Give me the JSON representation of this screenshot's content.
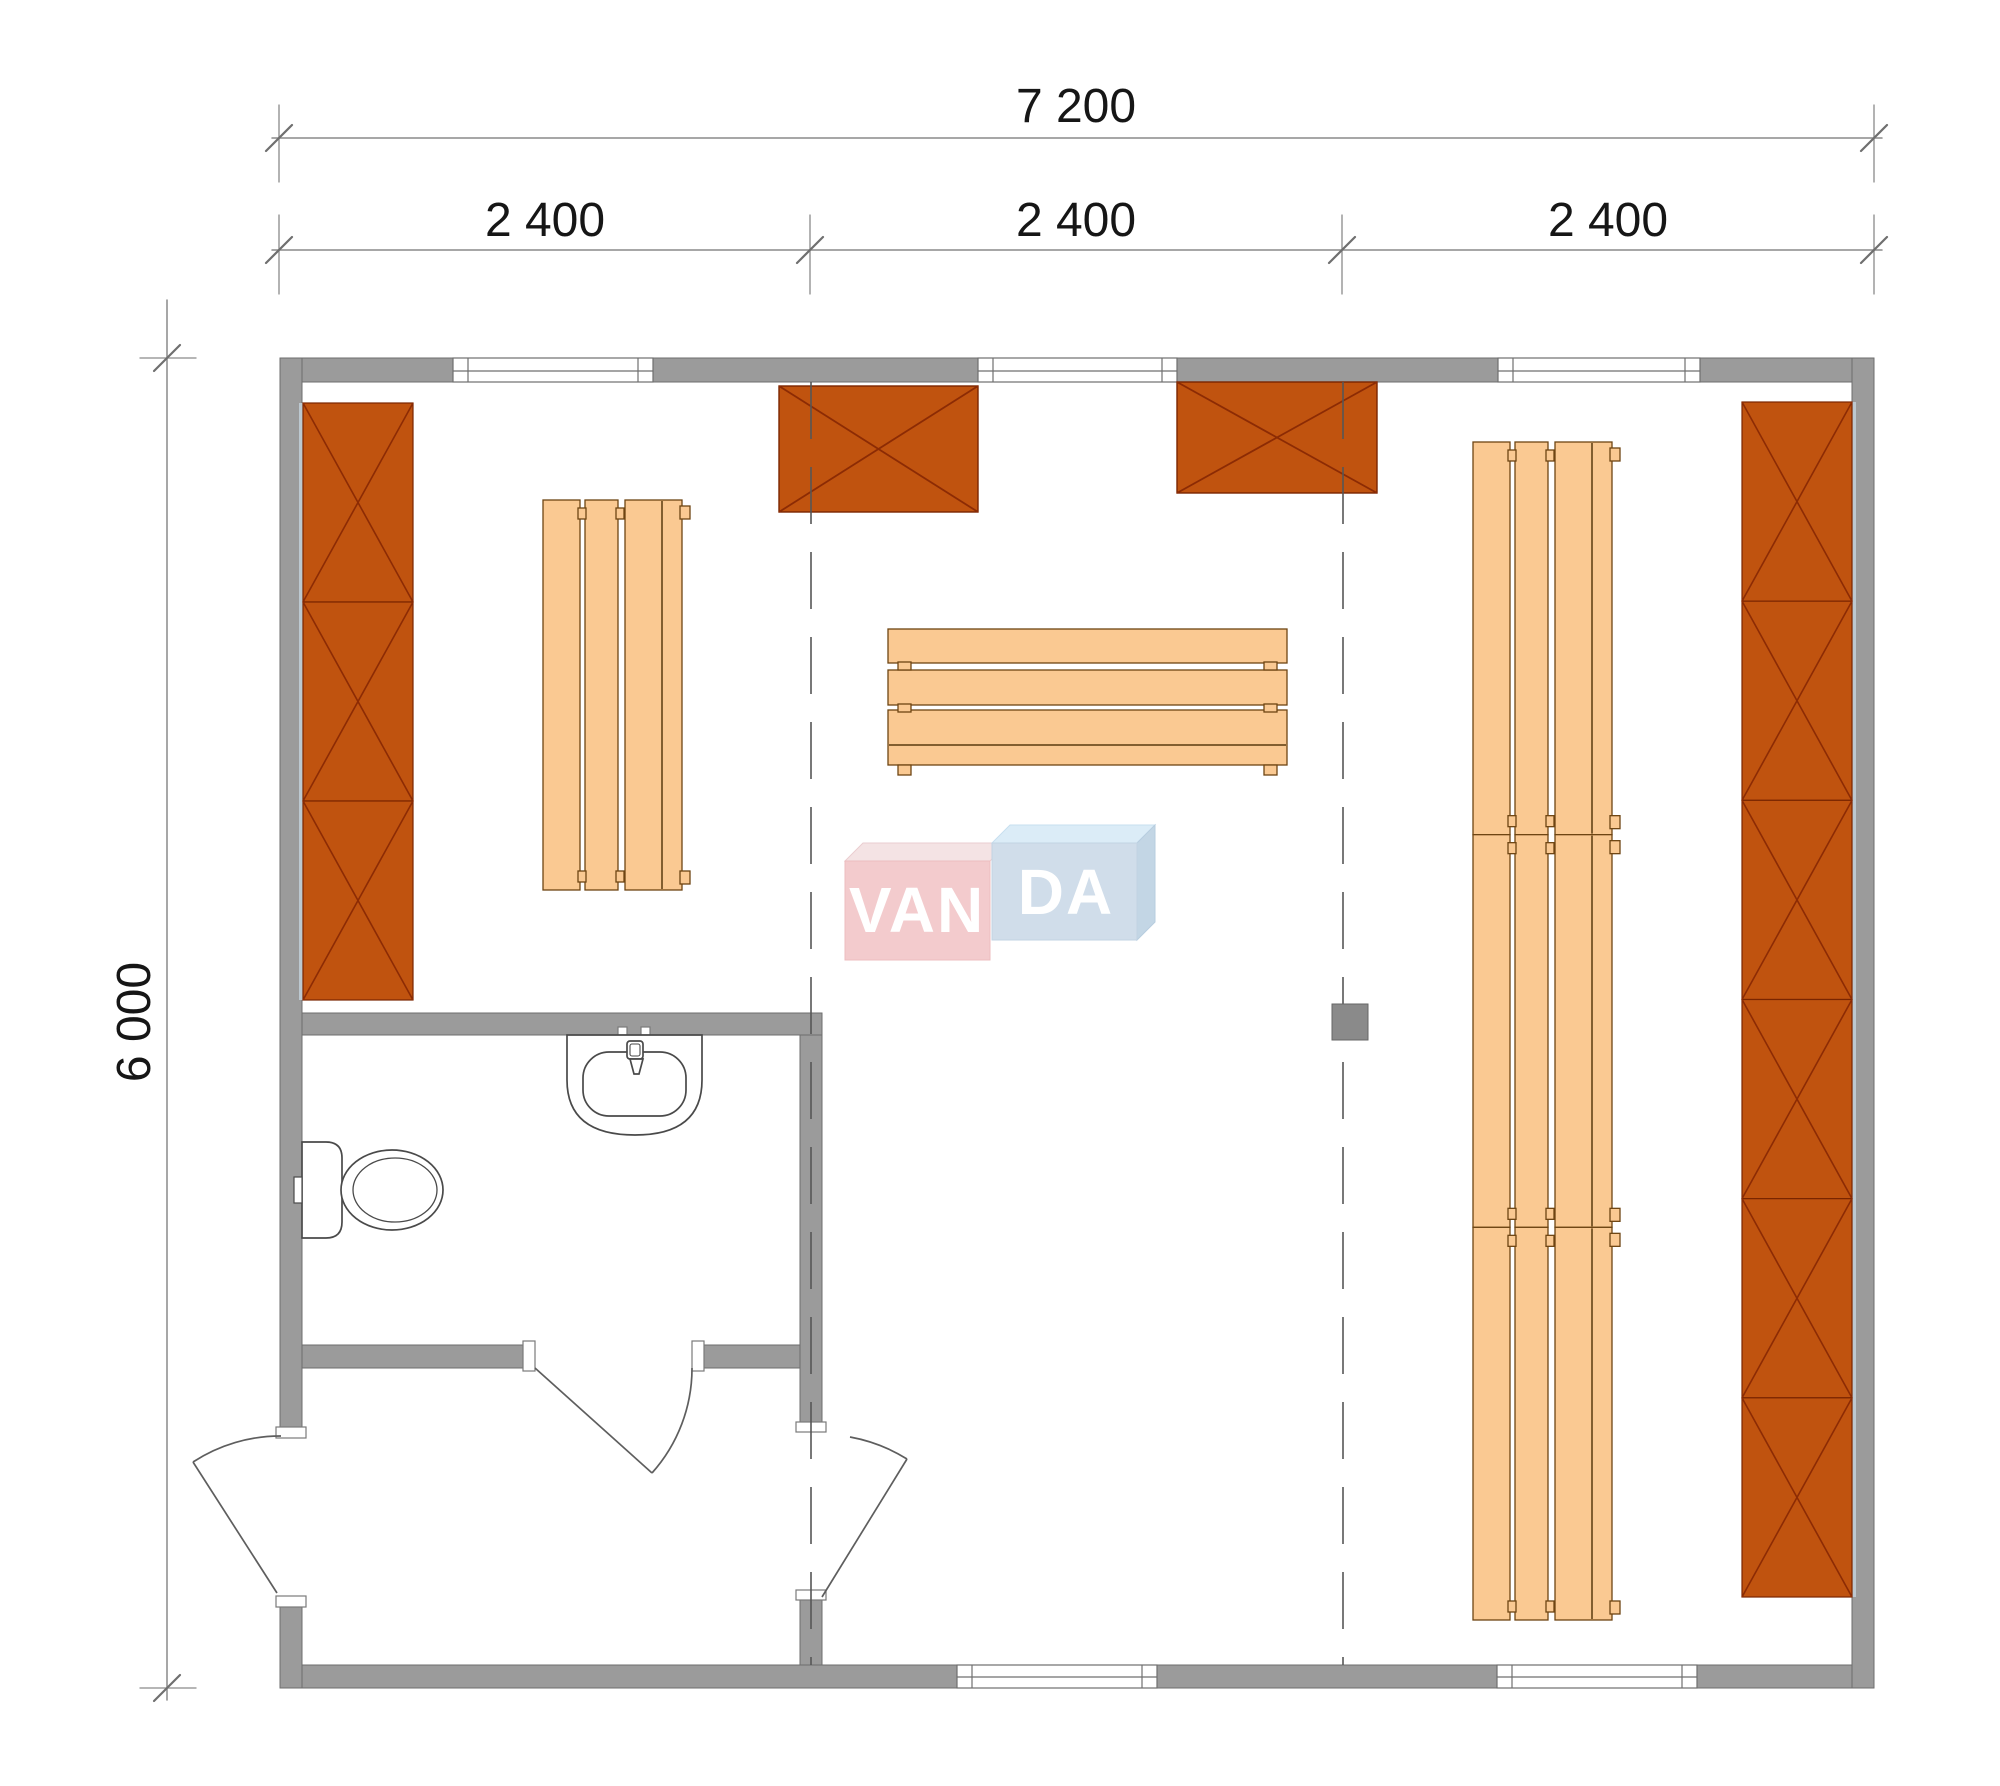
{
  "page": {
    "title": "Sauna house floor plan",
    "drawing_type": "architectural floor plan, top view"
  },
  "dimensions": {
    "overall_width_label": "7 200",
    "module_labels": [
      "2 400",
      "2 400",
      "2 400"
    ],
    "overall_depth_label": "6 000"
  },
  "watermark": {
    "brand": "VANDA",
    "left_part": "VAN",
    "right_part": "DA"
  },
  "colors": {
    "wall_fill": "#9B9B9B",
    "wall_edge": "#6E6E6E",
    "cabinet_fill": "#C0530F",
    "cabinet_edge": "#7A2500",
    "cabinet_cross": "#8C2B04",
    "bench_fill": "#FAC992",
    "bench_edge": "#6E4513",
    "bench_joint": "#5A3A0E",
    "grid_line": "#565656",
    "dim_line": "#8A8A8A",
    "dim_tick": "#6F6F6F",
    "dim_text": "#161616",
    "fixture_line": "#4A4A4A",
    "door_line": "#5E5E5E",
    "shadow_sliver": "#BCC8D0",
    "column_fill": "#8A8A8A",
    "watermark_pink": "#F2C6C8",
    "watermark_pink_top": "#F3E0E2",
    "watermark_blue": "#CBDAE8",
    "watermark_blue_top": "#D8EBF7",
    "watermark_blue_side": "#BDD2E3",
    "watermark_text": "#FFFFFF"
  },
  "elements": {
    "rooms": [
      "main sauna room",
      "washroom",
      "entrance vestibule"
    ],
    "doors": [
      "exterior entrance door (left wall)",
      "washroom door",
      "vestibule-to-sauna door"
    ],
    "windows": [
      "top window left",
      "top window center",
      "top window right",
      "bottom window center",
      "bottom window right"
    ],
    "fixtures": [
      "toilet",
      "washbasin with tap"
    ],
    "heaters": [
      "sauna heater left",
      "sauna heater right"
    ],
    "storage": [
      "left wall cabinet run (3 bays)",
      "right wall cabinet run (6 bays)"
    ],
    "benches": [
      "left vertical bench",
      "center bench",
      "right bench run (3 sections)"
    ]
  },
  "furniture": {
    "left_cabinet": {
      "x": 303,
      "y": 403,
      "w": 110,
      "h": 597,
      "sections": 3,
      "side": "left"
    },
    "right_cabinet": {
      "x": 1742,
      "y": 402,
      "w": 110,
      "h": 1195,
      "sections": 6,
      "side": "right"
    },
    "stoves": [
      {
        "x": 779,
        "y": 386,
        "w": 199,
        "h": 126
      },
      {
        "x": 1177,
        "y": 382,
        "w": 200,
        "h": 111
      }
    ],
    "bench_left": {
      "x": 543,
      "y": 500,
      "h": 390
    },
    "bench_right": {
      "x": 1473,
      "y": 442,
      "h": 1178,
      "sections": 3
    },
    "bench_center": {
      "x": 888,
      "y": 629,
      "w": 399
    },
    "column": {
      "x": 1332,
      "y": 1004,
      "size": 36
    }
  }
}
